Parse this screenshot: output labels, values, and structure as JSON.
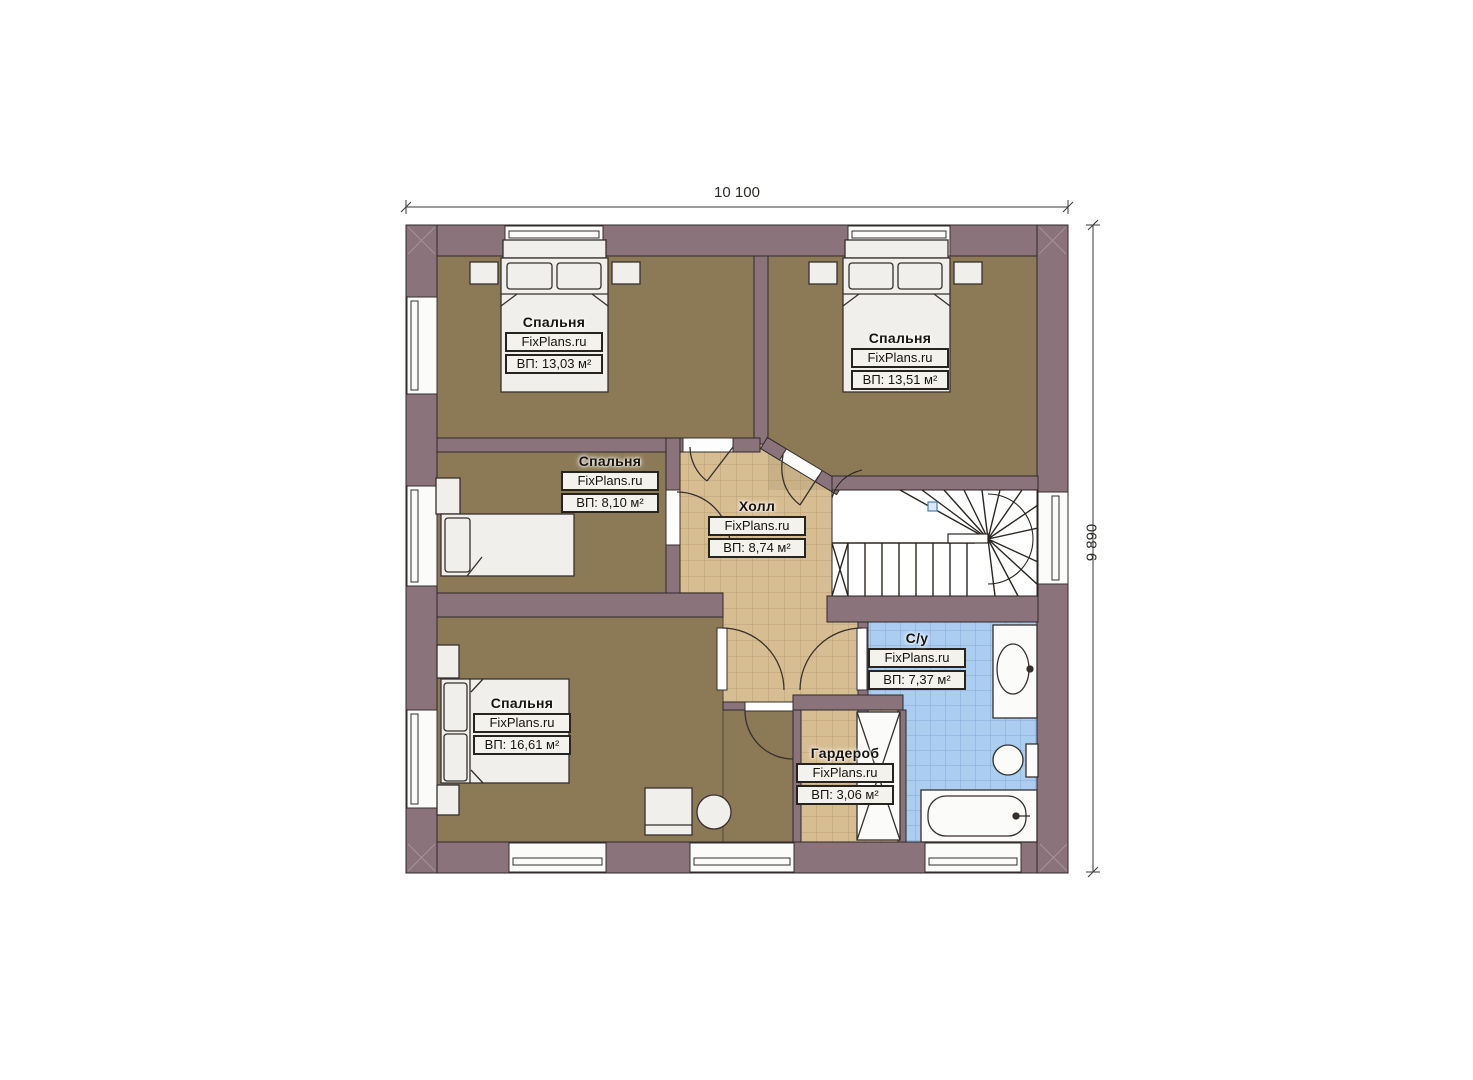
{
  "dimensions": {
    "width_label": "10 100",
    "height_label": "9 890"
  },
  "rooms": [
    {
      "id": "bedroom-top-left",
      "name": "Спальня",
      "brand": "FixPlans.ru",
      "area": "ВП: 13,03 м²"
    },
    {
      "id": "bedroom-top-right",
      "name": "Спальня",
      "brand": "FixPlans.ru",
      "area": "ВП: 13,51 м²"
    },
    {
      "id": "bedroom-mid-left",
      "name": "Спальня",
      "brand": "FixPlans.ru",
      "area": "ВП: 8,10 м²"
    },
    {
      "id": "hall",
      "name": "Холл",
      "brand": "FixPlans.ru",
      "area": "ВП: 8,74 м²"
    },
    {
      "id": "bedroom-bottom-left",
      "name": "Спальня",
      "brand": "FixPlans.ru",
      "area": "ВП: 16,61 м²"
    },
    {
      "id": "bathroom",
      "name": "С/у",
      "brand": "FixPlans.ru",
      "area": "ВП: 7,37 м²"
    },
    {
      "id": "wardrobe",
      "name": "Гардероб",
      "brand": "FixPlans.ru",
      "area": "ВП: 3,06 м²"
    }
  ],
  "colors": {
    "wall": "#8a737b",
    "wallLight": "#a5939a",
    "floorBrown": "#8d7a58",
    "floorBrownDark": "#7f6c4c",
    "tileTan": "#d7bd92",
    "tileTanLine": "#bb9f74",
    "tileBlue": "#aacdf0",
    "tileBlueLine": "#84abd8",
    "line": "#35302d",
    "furn": "#f0efeb",
    "white": "#fdfdfd",
    "dimLine": "#3a3a3a",
    "marker": "#4a7fb5"
  }
}
